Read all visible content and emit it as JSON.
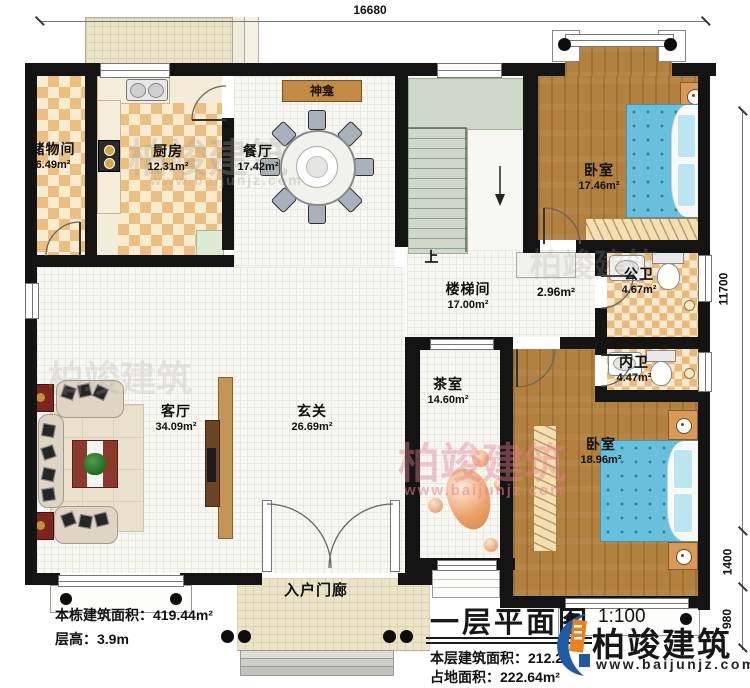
{
  "plan": {
    "title": "一层平面图",
    "scale": "1:100",
    "stats_left": [
      "本栋建筑面积：419.44m²",
      "层高：3.9m"
    ],
    "stats_right": [
      "本层建筑面积：212.2",
      "占地面积：222.64m²"
    ]
  },
  "dims": {
    "top": "16680",
    "right_total": "11700",
    "right_mid": "1400",
    "right_bottom": "980"
  },
  "rooms": {
    "storage": {
      "name": "储物间",
      "area": "6.49m²"
    },
    "kitchen": {
      "name": "厨房",
      "area": "12.31m²"
    },
    "dining": {
      "name": "餐厅",
      "area": "17.42m²"
    },
    "shrine": {
      "name": "神龛"
    },
    "bedroom_top": {
      "name": "卧室",
      "area": "17.46m²"
    },
    "stairwell": {
      "name": "楼梯间",
      "area": "17.00m²",
      "up": "上"
    },
    "corridor": {
      "area": "2.96m²"
    },
    "bath_public": {
      "name": "公卫",
      "area": "4.67m²"
    },
    "bath_private": {
      "name": "内卫",
      "area": "4.47m²"
    },
    "tearoom": {
      "name": "茶室",
      "area": "14.60m²"
    },
    "foyer": {
      "name": "玄关",
      "area": "26.69m²"
    },
    "living": {
      "name": "客厅",
      "area": "34.09m²"
    },
    "bedroom_bottom": {
      "name": "卧室",
      "area": "18.96m²"
    },
    "porch": {
      "name": "入户门廊"
    }
  },
  "brand": {
    "name": "柏竣建筑",
    "site": "www.baijunjz.com",
    "blue": "#1e5ba4",
    "orange": "#e8821d"
  },
  "watermark": {
    "name": "柏竣建筑",
    "site": "www.baijunjz.com"
  }
}
